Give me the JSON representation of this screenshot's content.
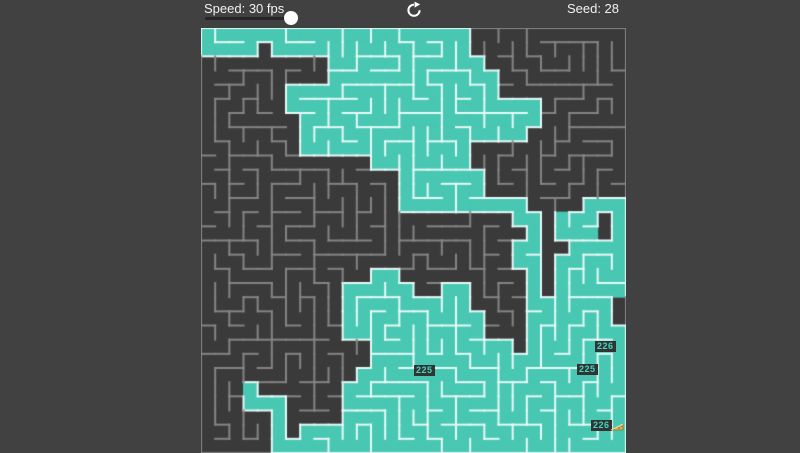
{
  "toolbar": {
    "speed_label": "Speed: 30 fps",
    "seed_label": "Seed: 28",
    "slider": {
      "value_fps": 30,
      "percent": 88
    },
    "refresh_icon": "circular-arrow-reload"
  },
  "maze": {
    "cols": 30,
    "rows": 30,
    "render_seed": 28,
    "flooded_cells": 430,
    "colors": {
      "page_bg": "#414141",
      "cell_dark": "#3a3a3a",
      "wall_gray": "#848484",
      "cell_flood": "#48c7b3",
      "wall_flood": "#e6faf6",
      "toolbar_text": "#f2f2f2",
      "slider_track": "#262626",
      "slider_knob": "#ffffff",
      "label_text": "#3fd8c0",
      "label_bg": "#333333",
      "goal_gold": "#d9b45c"
    },
    "labels": [
      {
        "text": "225"
      },
      {
        "text": "226"
      },
      {
        "text": "225"
      },
      {
        "text": "226"
      }
    ],
    "goal_icon": "goal-cheese"
  }
}
